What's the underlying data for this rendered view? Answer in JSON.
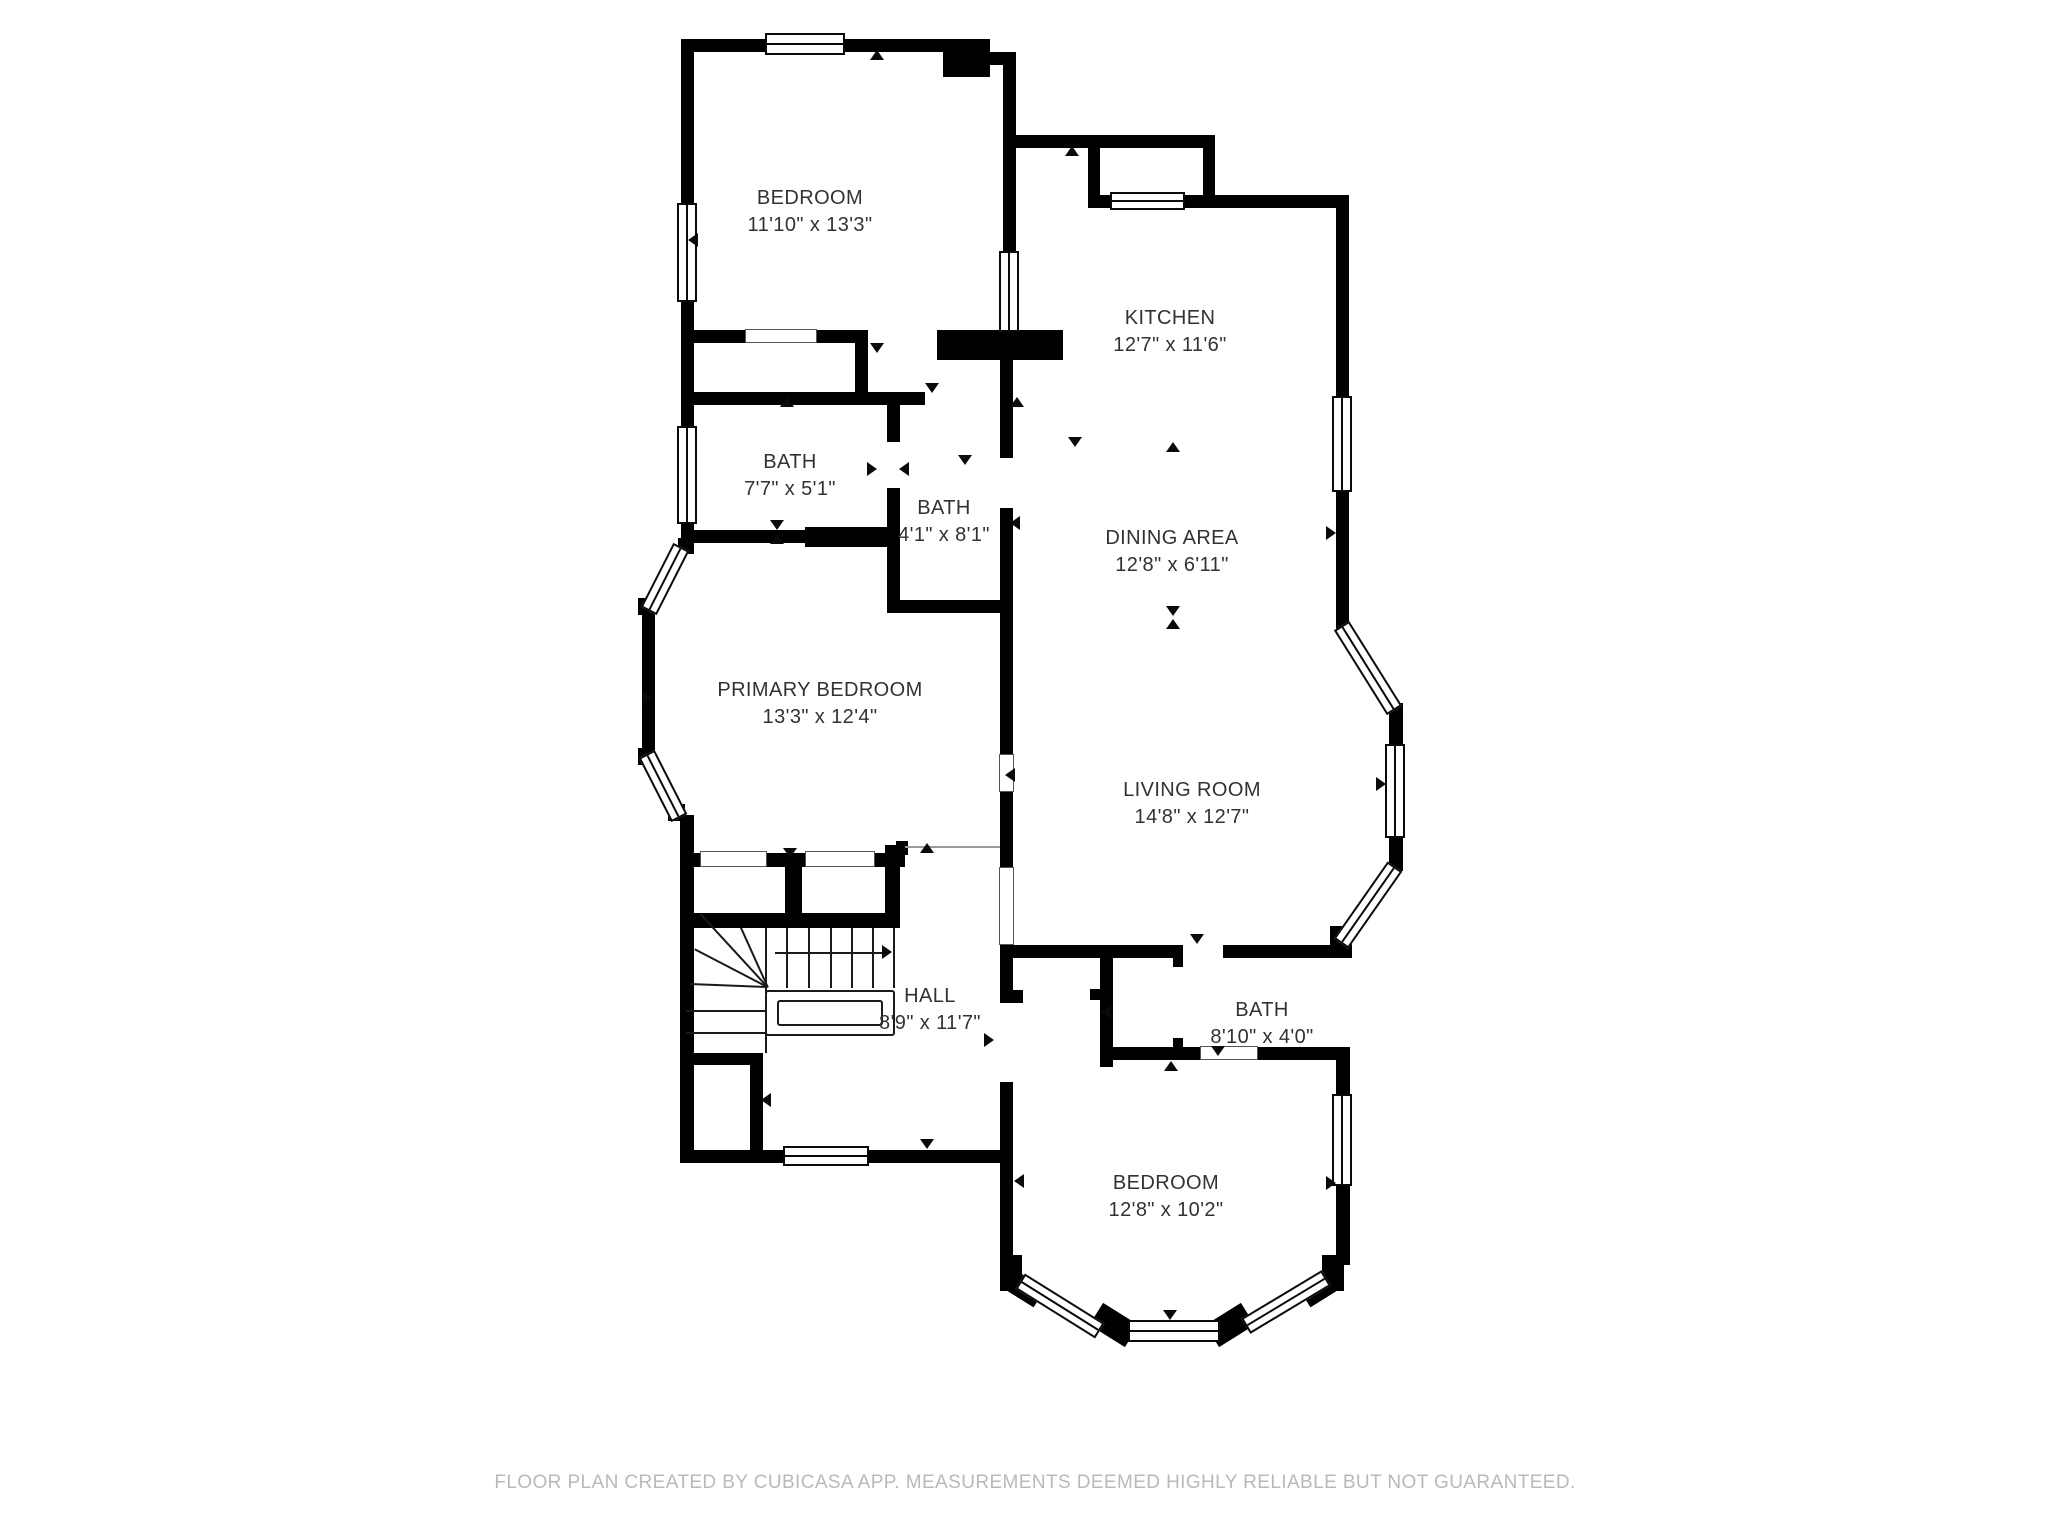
{
  "title": "Floor plan",
  "footer": {
    "text": "FLOOR PLAN CREATED BY CUBICASA APP. MEASUREMENTS DEEMED HIGHLY RELIABLE BUT NOT GUARANTEED.",
    "cx": 1035,
    "y": 1472
  },
  "colors": {
    "wall": "#000000",
    "label": "#323232",
    "footer": "#b9b9b9",
    "background": "#ffffff"
  },
  "rooms": [
    {
      "id": "bedroom-top",
      "name": "BEDROOM",
      "dims": "11'10\" x 13'3\"",
      "cx": 810,
      "cy": 198
    },
    {
      "id": "kitchen",
      "name": "KITCHEN",
      "dims": "12'7\" x 11'6\"",
      "cx": 1170,
      "cy": 318
    },
    {
      "id": "bath-1",
      "name": "BATH",
      "dims": "7'7\" x 5'1\"",
      "cx": 790,
      "cy": 462
    },
    {
      "id": "bath-2",
      "name": "BATH",
      "dims": "4'1\" x 8'1\"",
      "cx": 944,
      "cy": 508
    },
    {
      "id": "dining-area",
      "name": "DINING AREA",
      "dims": "12'8\" x 6'11\"",
      "cx": 1172,
      "cy": 538
    },
    {
      "id": "primary-bedroom",
      "name": "PRIMARY BEDROOM",
      "dims": "13'3\" x 12'4\"",
      "cx": 820,
      "cy": 690
    },
    {
      "id": "living-room",
      "name": "LIVING ROOM",
      "dims": "14'8\" x 12'7\"",
      "cx": 1192,
      "cy": 790
    },
    {
      "id": "hall",
      "name": "HALL",
      "dims": "8'9\" x 11'7\"",
      "cx": 930,
      "cy": 996
    },
    {
      "id": "bath-3",
      "name": "BATH",
      "dims": "8'10\" x 4'0\"",
      "cx": 1262,
      "cy": 1010
    },
    {
      "id": "bedroom-bottom",
      "name": "BEDROOM",
      "dims": "12'8\" x 10'2\"",
      "cx": 1166,
      "cy": 1183
    }
  ],
  "floorplan": {
    "walls": [
      {
        "x": 681,
        "y": 39,
        "w": 274,
        "h": 13
      },
      {
        "x": 943,
        "y": 39,
        "w": 47,
        "h": 38
      },
      {
        "x": 978,
        "y": 52,
        "w": 38,
        "h": 13
      },
      {
        "x": 1003,
        "y": 52,
        "w": 13,
        "h": 201
      },
      {
        "x": 681,
        "y": 39,
        "w": 13,
        "h": 506
      },
      {
        "x": 1016,
        "y": 135,
        "w": 199,
        "h": 13
      },
      {
        "x": 1088,
        "y": 148,
        "w": 12,
        "h": 59
      },
      {
        "x": 1203,
        "y": 135,
        "w": 12,
        "h": 73
      },
      {
        "x": 1088,
        "y": 195,
        "w": 260,
        "h": 13
      },
      {
        "x": 1336,
        "y": 195,
        "w": 13,
        "h": 433
      },
      {
        "x": 1336,
        "y": 615,
        "w": 13,
        "h": 18
      },
      {
        "x": 1389,
        "y": 703,
        "w": 14,
        "h": 50
      },
      {
        "x": 1389,
        "y": 833,
        "w": 14,
        "h": 38
      },
      {
        "x": 1330,
        "y": 926,
        "w": 22,
        "h": 32
      },
      {
        "x": 1001,
        "y": 945,
        "w": 172,
        "h": 13
      },
      {
        "x": 1173,
        "y": 945,
        "w": 10,
        "h": 22
      },
      {
        "x": 1223,
        "y": 945,
        "w": 120,
        "h": 13
      },
      {
        "x": 1000,
        "y": 358,
        "w": 13,
        "h": 100
      },
      {
        "x": 1000,
        "y": 508,
        "w": 13,
        "h": 246
      },
      {
        "x": 1000,
        "y": 792,
        "w": 13,
        "h": 77
      },
      {
        "x": 1000,
        "y": 945,
        "w": 13,
        "h": 58
      },
      {
        "x": 1013,
        "y": 990,
        "w": 10,
        "h": 13
      },
      {
        "x": 1000,
        "y": 1082,
        "w": 13,
        "h": 180
      },
      {
        "x": 937,
        "y": 330,
        "w": 126,
        "h": 30
      },
      {
        "x": 694,
        "y": 330,
        "w": 51,
        "h": 13
      },
      {
        "x": 817,
        "y": 330,
        "w": 51,
        "h": 13
      },
      {
        "x": 855,
        "y": 330,
        "w": 13,
        "h": 72
      },
      {
        "x": 681,
        "y": 392,
        "w": 244,
        "h": 13
      },
      {
        "x": 887,
        "y": 402,
        "w": 13,
        "h": 40
      },
      {
        "x": 887,
        "y": 488,
        "w": 13,
        "h": 125
      },
      {
        "x": 681,
        "y": 530,
        "w": 124,
        "h": 13
      },
      {
        "x": 805,
        "y": 527,
        "w": 83,
        "h": 20
      },
      {
        "x": 887,
        "y": 600,
        "w": 126,
        "h": 13
      },
      {
        "x": 642,
        "y": 608,
        "w": 13,
        "h": 150
      },
      {
        "x": 678,
        "y": 538,
        "w": 16,
        "h": 16
      },
      {
        "x": 638,
        "y": 598,
        "w": 17,
        "h": 17
      },
      {
        "x": 638,
        "y": 748,
        "w": 17,
        "h": 17
      },
      {
        "x": 668,
        "y": 804,
        "w": 17,
        "h": 17
      },
      {
        "x": 680,
        "y": 815,
        "w": 14,
        "h": 48
      },
      {
        "x": 680,
        "y": 853,
        "w": 22,
        "h": 14
      },
      {
        "x": 767,
        "y": 853,
        "w": 38,
        "h": 14
      },
      {
        "x": 875,
        "y": 853,
        "w": 30,
        "h": 14
      },
      {
        "x": 896,
        "y": 841,
        "w": 12,
        "h": 14
      },
      {
        "x": 885,
        "y": 845,
        "w": 15,
        "h": 82
      },
      {
        "x": 785,
        "y": 867,
        "w": 17,
        "h": 48
      },
      {
        "x": 694,
        "y": 913,
        "w": 206,
        "h": 15
      },
      {
        "x": 680,
        "y": 845,
        "w": 14,
        "h": 318
      },
      {
        "x": 685,
        "y": 1053,
        "w": 78,
        "h": 12
      },
      {
        "x": 750,
        "y": 1053,
        "w": 13,
        "h": 100
      },
      {
        "x": 680,
        "y": 1150,
        "w": 333,
        "h": 13
      },
      {
        "x": 1100,
        "y": 957,
        "w": 13,
        "h": 110
      },
      {
        "x": 1090,
        "y": 989,
        "w": 11,
        "h": 11
      },
      {
        "x": 1100,
        "y": 1047,
        "w": 100,
        "h": 13
      },
      {
        "x": 1173,
        "y": 1038,
        "w": 10,
        "h": 10
      },
      {
        "x": 1258,
        "y": 1047,
        "w": 85,
        "h": 13
      },
      {
        "x": 1336,
        "y": 1047,
        "w": 14,
        "h": 55
      },
      {
        "x": 1336,
        "y": 1180,
        "w": 14,
        "h": 85
      },
      {
        "x": 1000,
        "y": 1255,
        "w": 22,
        "h": 36
      },
      {
        "x": 1322,
        "y": 1255,
        "w": 22,
        "h": 36
      },
      {
        "x": 1093,
        "y": 1312,
        "w": 42,
        "h": 26,
        "rot": 32
      },
      {
        "x": 1209,
        "y": 1312,
        "w": 42,
        "h": 26,
        "rot": -32
      },
      {
        "x": 1008,
        "y": 1278,
        "w": 34,
        "h": 22,
        "rot": 32
      },
      {
        "x": 1302,
        "y": 1278,
        "w": 34,
        "h": 22,
        "rot": -32
      }
    ],
    "windows": [
      {
        "x": 765,
        "y": 33,
        "w": 80,
        "h": 22,
        "o": "h"
      },
      {
        "x": 677,
        "y": 203,
        "w": 20,
        "h": 99,
        "o": "v"
      },
      {
        "x": 677,
        "y": 426,
        "w": 20,
        "h": 98,
        "o": "v"
      },
      {
        "x": 999,
        "y": 251,
        "w": 20,
        "h": 81,
        "o": "v"
      },
      {
        "x": 1110,
        "y": 192,
        "w": 75,
        "h": 18,
        "o": "h"
      },
      {
        "x": 1332,
        "y": 396,
        "w": 20,
        "h": 96,
        "o": "v"
      },
      {
        "x": 1385,
        "y": 744,
        "w": 20,
        "h": 94,
        "o": "v"
      },
      {
        "x": 783,
        "y": 1146,
        "w": 86,
        "h": 20,
        "o": "h"
      },
      {
        "x": 1332,
        "y": 1094,
        "w": 20,
        "h": 92,
        "o": "v"
      },
      {
        "x": 1128,
        "y": 1320,
        "w": 92,
        "h": 22,
        "o": "h"
      }
    ],
    "angled_windows": [
      {
        "cx": 665,
        "cy": 579,
        "len": 72,
        "deg": 117
      },
      {
        "cx": 663,
        "cy": 786,
        "len": 72,
        "deg": 63
      },
      {
        "cx": 1368,
        "cy": 668,
        "len": 100,
        "deg": 58
      },
      {
        "cx": 1368,
        "cy": 905,
        "len": 94,
        "deg": -55
      },
      {
        "cx": 1060,
        "cy": 1306,
        "len": 94,
        "deg": 32
      },
      {
        "cx": 1286,
        "cy": 1302,
        "len": 94,
        "deg": -31
      }
    ],
    "sliders": [
      {
        "x": 745,
        "y": 329,
        "w": 72,
        "h": 14
      },
      {
        "x": 700,
        "y": 851,
        "w": 67,
        "h": 16
      },
      {
        "x": 805,
        "y": 851,
        "w": 70,
        "h": 16
      },
      {
        "x": 999,
        "y": 754,
        "w": 15,
        "h": 38
      },
      {
        "x": 999,
        "y": 867,
        "w": 15,
        "h": 78
      },
      {
        "x": 1200,
        "y": 1046,
        "w": 58,
        "h": 14
      }
    ],
    "thin_lines": [
      {
        "x": 905,
        "y": 846,
        "w": 95,
        "h": 2
      }
    ],
    "triangles": [
      {
        "x": 877,
        "y": 57,
        "dir": "up"
      },
      {
        "x": 695,
        "y": 240,
        "dir": "left"
      },
      {
        "x": 877,
        "y": 350,
        "dir": "down"
      },
      {
        "x": 1072,
        "y": 153,
        "dir": "up"
      },
      {
        "x": 787,
        "y": 404,
        "dir": "up"
      },
      {
        "x": 932,
        "y": 390,
        "dir": "down"
      },
      {
        "x": 1017,
        "y": 404,
        "dir": "up"
      },
      {
        "x": 874,
        "y": 469,
        "dir": "right"
      },
      {
        "x": 906,
        "y": 469,
        "dir": "left"
      },
      {
        "x": 777,
        "y": 527,
        "dir": "down"
      },
      {
        "x": 777,
        "y": 541,
        "dir": "up"
      },
      {
        "x": 965,
        "y": 462,
        "dir": "down"
      },
      {
        "x": 1017,
        "y": 523,
        "dir": "left"
      },
      {
        "x": 1075,
        "y": 444,
        "dir": "down"
      },
      {
        "x": 1173,
        "y": 449,
        "dir": "up"
      },
      {
        "x": 1333,
        "y": 533,
        "dir": "right"
      },
      {
        "x": 1173,
        "y": 613,
        "dir": "down"
      },
      {
        "x": 1173,
        "y": 626,
        "dir": "up"
      },
      {
        "x": 650,
        "y": 698,
        "dir": "right"
      },
      {
        "x": 1012,
        "y": 775,
        "dir": "left"
      },
      {
        "x": 1383,
        "y": 784,
        "dir": "right"
      },
      {
        "x": 927,
        "y": 850,
        "dir": "up"
      },
      {
        "x": 790,
        "y": 855,
        "dir": "down"
      },
      {
        "x": 768,
        "y": 1100,
        "dir": "left"
      },
      {
        "x": 991,
        "y": 1040,
        "dir": "right"
      },
      {
        "x": 1108,
        "y": 1012,
        "dir": "left"
      },
      {
        "x": 927,
        "y": 1146,
        "dir": "down"
      },
      {
        "x": 1197,
        "y": 941,
        "dir": "down"
      },
      {
        "x": 1218,
        "y": 1053,
        "dir": "down"
      },
      {
        "x": 1171,
        "y": 1068,
        "dir": "up"
      },
      {
        "x": 1333,
        "y": 1183,
        "dir": "right"
      },
      {
        "x": 1021,
        "y": 1181,
        "dir": "left"
      },
      {
        "x": 1170,
        "y": 1317,
        "dir": "down"
      }
    ],
    "stairs": {
      "lines": [
        {
          "x1": 788,
          "y1": 928,
          "x2": 788,
          "y2": 988
        },
        {
          "x1": 810,
          "y1": 928,
          "x2": 810,
          "y2": 988
        },
        {
          "x1": 832,
          "y1": 928,
          "x2": 832,
          "y2": 988
        },
        {
          "x1": 853,
          "y1": 928,
          "x2": 853,
          "y2": 988
        },
        {
          "x1": 874,
          "y1": 928,
          "x2": 874,
          "y2": 988
        },
        {
          "x1": 895,
          "y1": 928,
          "x2": 895,
          "y2": 988
        },
        {
          "x1": 767,
          "y1": 928,
          "x2": 767,
          "y2": 1053
        },
        {
          "x1": 686,
          "y1": 1010,
          "x2": 767,
          "y2": 1010
        },
        {
          "x1": 686,
          "y1": 1032,
          "x2": 767,
          "y2": 1032
        },
        {
          "x1": 767,
          "y1": 988,
          "x2": 700,
          "y2": 915
        },
        {
          "x1": 767,
          "y1": 988,
          "x2": 740,
          "y2": 928
        },
        {
          "x1": 767,
          "y1": 988,
          "x2": 694,
          "y2": 950
        },
        {
          "x1": 767,
          "y1": 988,
          "x2": 690,
          "y2": 985
        },
        {
          "x1": 775,
          "y1": 952,
          "x2": 884,
          "y2": 952
        }
      ],
      "arrow": {
        "x": 889,
        "y": 952,
        "dir": "right"
      },
      "railing_outer": {
        "x": 765,
        "y": 990,
        "w": 130,
        "h": 46
      },
      "railing_inner": {
        "x": 777,
        "y": 1000,
        "w": 106,
        "h": 26
      }
    }
  }
}
